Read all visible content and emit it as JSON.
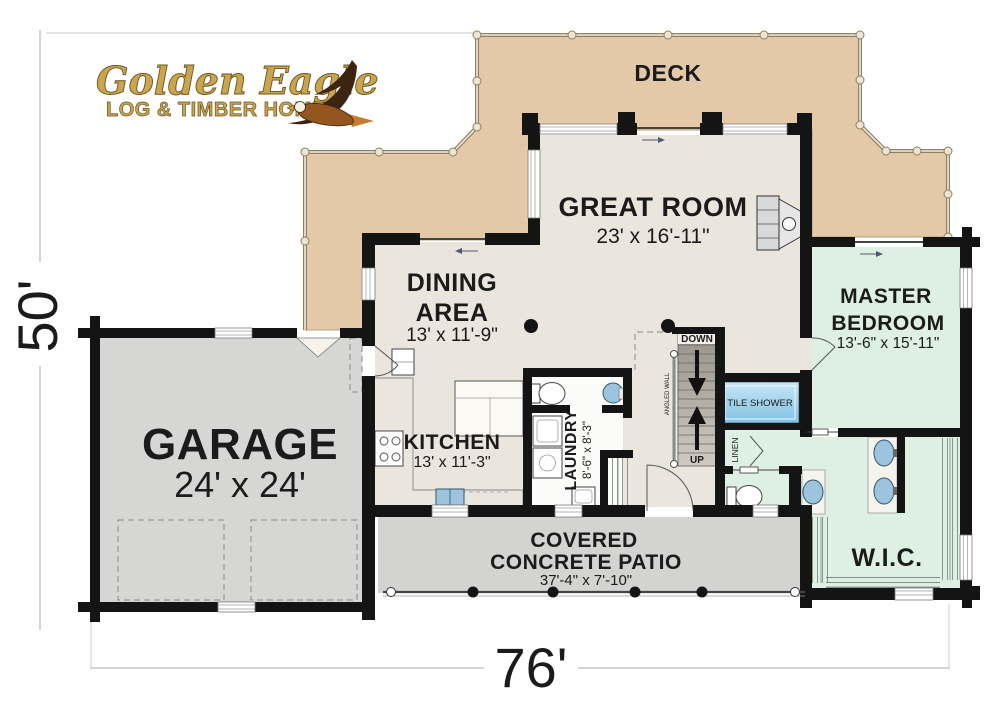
{
  "logo": {
    "line1": "Golden Eagle",
    "line2": "LOG & TIMBER HOMES"
  },
  "dimensions": {
    "overall_width": "76'",
    "overall_height": "50'"
  },
  "rooms": {
    "deck": {
      "label": "DECK"
    },
    "great_room": {
      "label": "GREAT ROOM",
      "dims": "23' x 16'-11\""
    },
    "dining_area": {
      "label_line1": "DINING",
      "label_line2": "AREA",
      "dims": "13' x 11'-9\""
    },
    "master_bedroom": {
      "label_line1": "MASTER",
      "label_line2": "BEDROOM",
      "dims": "13'-6\" x 15'-11\""
    },
    "garage": {
      "label": "GARAGE",
      "dims": "24' x 24'"
    },
    "kitchen": {
      "label": "KITCHEN",
      "dims": "13' x 11'-3\""
    },
    "laundry": {
      "label": "LAUNDRY",
      "dims": "8'-6\" x 8'-3\""
    },
    "covered_patio": {
      "label_line1": "COVERED",
      "label_line2": "CONCRETE PATIO",
      "dims": "37'-4\" x 7'-10\""
    },
    "wic": {
      "label": "W.I.C."
    },
    "tile_shower": {
      "label": "TILE SHOWER"
    },
    "linen": {
      "label": "LINEN"
    }
  },
  "stairs": {
    "down_label": "DOWN",
    "up_label": "UP",
    "angled_wall_label": "ANGLED WALL"
  },
  "colors": {
    "deck": "#e4c9a8",
    "interior": "#eae6de",
    "garage": "#d6d6d4",
    "patio": "#d3d3d1",
    "suite_green": "#def0e4",
    "shower_blue": "#a9d6ec",
    "fixture_blue": "#9cc4dd",
    "wall": "#141414",
    "logo_gold": "#c9a550"
  }
}
